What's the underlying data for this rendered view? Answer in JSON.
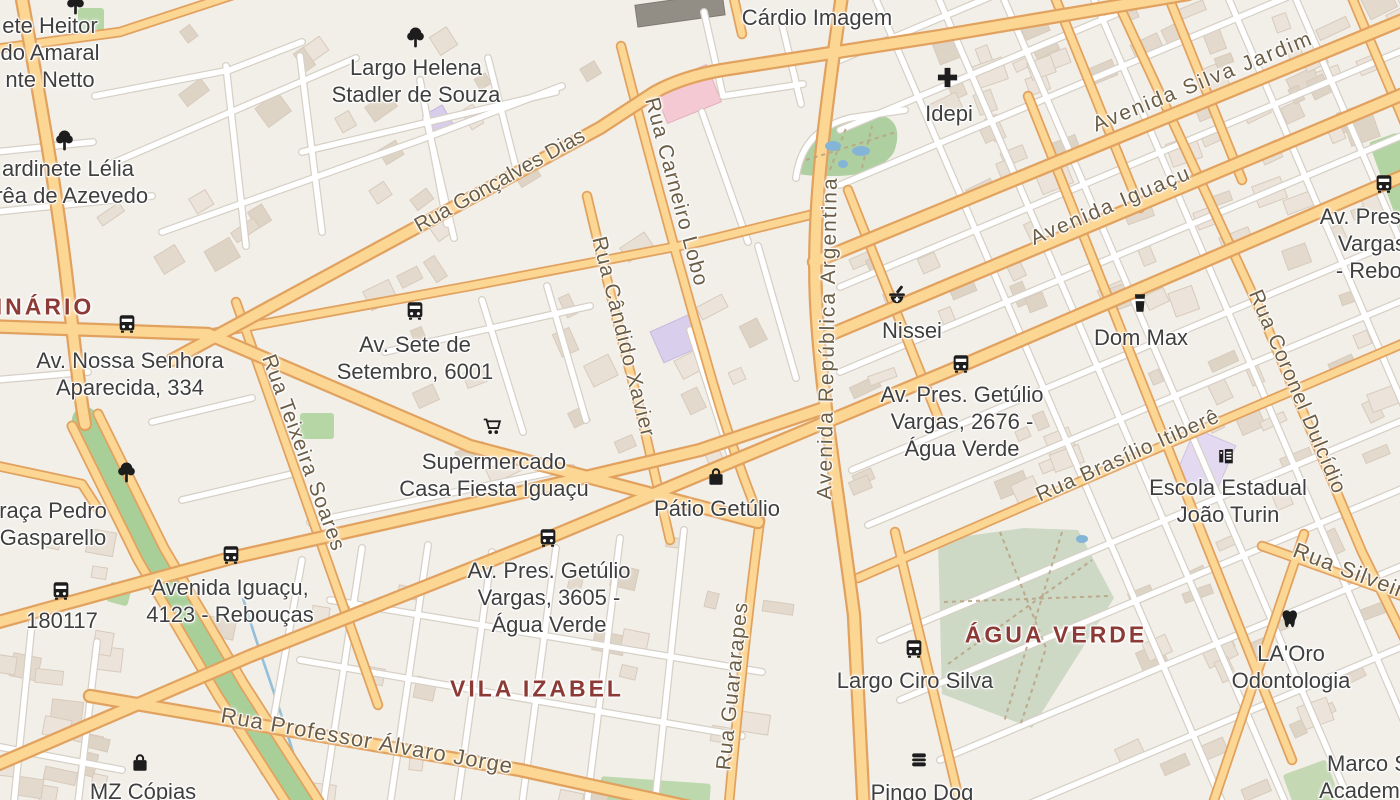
{
  "map": {
    "colors": {
      "background": "#f2efe9",
      "major_road_fill": "#fcd693",
      "major_road_casing": "#e2a25f",
      "minor_road_fill": "#ffffff",
      "minor_road_casing": "#d6d0c6",
      "park_green": "#aecfa0",
      "muted_park_green": "#cdd8c5",
      "water": "#93bfdb",
      "district_label": "#8c3a35",
      "poi_label": "#3f3f3f",
      "road_label": "#6c5e46",
      "icon_color": "#1d1d1d"
    },
    "districts": [
      {
        "name": "INÁRIO",
        "x": 45,
        "y": 307
      },
      {
        "name": "VILA IZABEL",
        "x": 537,
        "y": 689
      },
      {
        "name": "ÁGUA VERDE",
        "x": 1056,
        "y": 635
      }
    ],
    "road_labels": [
      {
        "text": "Rua Gonçalves Dias",
        "x": 500,
        "y": 181,
        "rot": -29,
        "ls": 0
      },
      {
        "text": "Rua Carneiro Lobo",
        "x": 676,
        "y": 192,
        "rot": 75,
        "ls": 1
      },
      {
        "text": "Rua Cândido Xavier",
        "x": 623,
        "y": 337,
        "rot": 76,
        "ls": 1
      },
      {
        "text": "Avenida República Argentina",
        "x": 828,
        "y": 338,
        "rot": -89,
        "ls": 2
      },
      {
        "text": "Avenida Silva Jardim",
        "x": 1203,
        "y": 82,
        "rot": -22,
        "ls": 2
      },
      {
        "text": "Avenida Iguaçu",
        "x": 1111,
        "y": 206,
        "rot": -23,
        "ls": 2
      },
      {
        "text": "Rua Teixeira Soares",
        "x": 303,
        "y": 453,
        "rot": 70,
        "ls": 1
      },
      {
        "text": "Rua Brasílio Itiberê",
        "x": 1128,
        "y": 456,
        "rot": -24,
        "ls": 1
      },
      {
        "text": "Rua Coronel Dulcídio",
        "x": 1297,
        "y": 392,
        "rot": 67,
        "ls": 1
      },
      {
        "text": "Rua Guararapes",
        "x": 733,
        "y": 686,
        "rot": -84,
        "ls": 1
      },
      {
        "text": "Rua Professor Álvaro Jorge",
        "x": 367,
        "y": 741,
        "rot": 10,
        "ls": 1,
        "size": 22
      },
      {
        "text": "Rua Silveira",
        "x": 1355,
        "y": 573,
        "rot": 21,
        "ls": 1,
        "size": 22
      }
    ],
    "places": [
      {
        "id": "heitor",
        "lines": [
          "ete Heitor",
          "do Amaral",
          "nte Netto"
        ],
        "x": 50,
        "y": 12
      },
      {
        "id": "largo-helena",
        "lines": [
          "Largo Helena",
          "Stadler de Souza"
        ],
        "x": 416,
        "y": 54
      },
      {
        "id": "lelia",
        "lines": [
          "ardinete Lélia",
          "rrêa de Azevedo"
        ],
        "x": 68,
        "y": 155
      },
      {
        "id": "cardio",
        "lines": [
          "Cárdio Imagem"
        ],
        "x": 817,
        "y": 4
      },
      {
        "id": "idepi",
        "lines": [
          "Idepi"
        ],
        "x": 949,
        "y": 100
      },
      {
        "id": "sete",
        "lines": [
          "Av. Sete de",
          "Setembro, 6001"
        ],
        "x": 415,
        "y": 331
      },
      {
        "id": "nossa",
        "lines": [
          "Av. Nossa Senhora",
          "Aparecida, 334"
        ],
        "x": 130,
        "y": 347
      },
      {
        "id": "nissei",
        "lines": [
          "Nissei"
        ],
        "x": 912,
        "y": 317
      },
      {
        "id": "dom-max",
        "lines": [
          "Dom Max"
        ],
        "x": 1141,
        "y": 324
      },
      {
        "id": "getulio-2676",
        "lines": [
          "Av. Pres. Getúlio",
          "Vargas, 2676 -",
          "Água Verde"
        ],
        "x": 962,
        "y": 381
      },
      {
        "id": "getulio-reb",
        "lines": [
          "Av. Pres. G",
          "Vargas,",
          "- Rebou"
        ],
        "x": 1375,
        "y": 203
      },
      {
        "id": "supermercado",
        "lines": [
          "Supermercado",
          "Casa Fiesta Iguaçu"
        ],
        "x": 494,
        "y": 448
      },
      {
        "id": "patio",
        "lines": [
          "Pátio Getúlio"
        ],
        "x": 717,
        "y": 495
      },
      {
        "id": "escola",
        "lines": [
          "Escola Estadual",
          "João Turin"
        ],
        "x": 1228,
        "y": 474
      },
      {
        "id": "iguacu-4123",
        "lines": [
          "Avenida Iguaçu,",
          "4123 - Rebouças"
        ],
        "x": 230,
        "y": 574
      },
      {
        "id": "b180117",
        "lines": [
          "180117"
        ],
        "x": 62,
        "y": 607
      },
      {
        "id": "getulio-3605",
        "lines": [
          "Av. Pres. Getúlio",
          "Vargas, 3605 -",
          "Água Verde"
        ],
        "x": 549,
        "y": 557
      },
      {
        "id": "largo-ciro",
        "lines": [
          "Largo Ciro Silva"
        ],
        "x": 915,
        "y": 667
      },
      {
        "id": "laoro",
        "lines": [
          "LA'Oro",
          "Odontologia"
        ],
        "x": 1291,
        "y": 640
      },
      {
        "id": "marco",
        "lines": [
          "Marco S",
          "Academia"
        ],
        "x": 1368,
        "y": 750
      },
      {
        "id": "mz-copias",
        "lines": [
          "MZ Cópias"
        ],
        "x": 143,
        "y": 778
      },
      {
        "id": "pingo-dog",
        "lines": [
          "Pingo Dog"
        ],
        "x": 922,
        "y": 779
      },
      {
        "id": "praca-pedro",
        "lines": [
          "raça Pedro",
          "Gasparello"
        ],
        "x": 53,
        "y": 497
      }
    ],
    "icons": [
      {
        "glyph": "tree",
        "x": 75,
        "y": 4
      },
      {
        "glyph": "tree",
        "x": 415,
        "y": 37
      },
      {
        "glyph": "tree",
        "x": 64,
        "y": 140
      },
      {
        "glyph": "tree",
        "x": 126,
        "y": 472
      },
      {
        "glyph": "bus",
        "x": 415,
        "y": 311
      },
      {
        "glyph": "bus",
        "x": 127,
        "y": 324
      },
      {
        "glyph": "bus",
        "x": 961,
        "y": 364
      },
      {
        "glyph": "bus",
        "x": 1384,
        "y": 184
      },
      {
        "glyph": "bus",
        "x": 231,
        "y": 555
      },
      {
        "glyph": "bus",
        "x": 61,
        "y": 591
      },
      {
        "glyph": "bus",
        "x": 548,
        "y": 538
      },
      {
        "glyph": "bus",
        "x": 914,
        "y": 649
      },
      {
        "glyph": "cross",
        "x": 947,
        "y": 77
      },
      {
        "glyph": "pharmacy",
        "x": 897,
        "y": 295
      },
      {
        "glyph": "pint",
        "x": 1140,
        "y": 303
      },
      {
        "glyph": "school",
        "x": 1226,
        "y": 456
      },
      {
        "glyph": "cart",
        "x": 492,
        "y": 427
      },
      {
        "glyph": "bag",
        "x": 716,
        "y": 477
      },
      {
        "glyph": "bag",
        "x": 140,
        "y": 763
      },
      {
        "glyph": "burger",
        "x": 919,
        "y": 760
      },
      {
        "glyph": "tooth",
        "x": 1290,
        "y": 619
      }
    ]
  }
}
